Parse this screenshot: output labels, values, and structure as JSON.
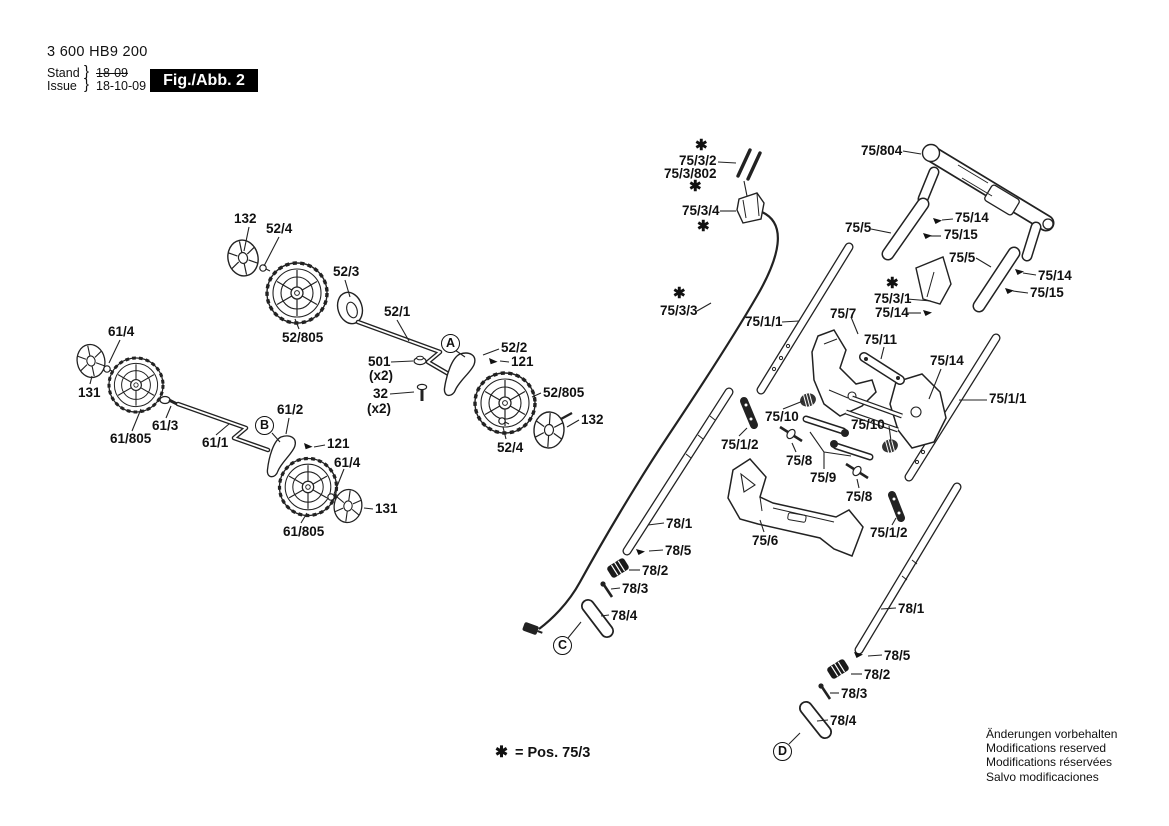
{
  "header": {
    "type_number": "3 600 HB9 200",
    "stand_label": "Stand",
    "issue_label": "Issue",
    "brace": "}",
    "old_date": "18-09",
    "new_date": "18-10-09",
    "figure_label": "Fig./Abb. 2"
  },
  "legend": {
    "asterisk": "✱",
    "text": "= Pos. 75/3"
  },
  "footer_lines": [
    "Änderungen vorbehalten",
    "Modifications reserved",
    "Modifications réservées",
    "Salvo modificaciones"
  ],
  "view_markers": {
    "a": "A",
    "b": "B",
    "c": "C",
    "d": "D"
  },
  "callouts": [
    {
      "text": "132"
    },
    {
      "text": "52/4"
    },
    {
      "text": "52/3"
    },
    {
      "text": "52/1"
    },
    {
      "text": "52/805"
    },
    {
      "text": "501"
    },
    {
      "text": "(x2)"
    },
    {
      "text": "32"
    },
    {
      "text": "(x2)"
    },
    {
      "text": "52/2"
    },
    {
      "text": "121"
    },
    {
      "text": "52/805"
    },
    {
      "text": "132"
    },
    {
      "text": "52/4"
    },
    {
      "text": "61/4"
    },
    {
      "text": "131"
    },
    {
      "text": "61/805"
    },
    {
      "text": "61/3"
    },
    {
      "text": "61/1"
    },
    {
      "text": "61/2"
    },
    {
      "text": "121"
    },
    {
      "text": "61/4"
    },
    {
      "text": "131"
    },
    {
      "text": "61/805"
    },
    {
      "text": "✱"
    },
    {
      "text": "75/3/2"
    },
    {
      "text": "75/3/802"
    },
    {
      "text": "✱"
    },
    {
      "text": "75/3/4"
    },
    {
      "text": "✱"
    },
    {
      "text": "75/804"
    },
    {
      "text": "75/5"
    },
    {
      "text": "75/14"
    },
    {
      "text": "75/15"
    },
    {
      "text": "75/5"
    },
    {
      "text": "75/14"
    },
    {
      "text": "75/15"
    },
    {
      "text": "✱"
    },
    {
      "text": "75/3/1"
    },
    {
      "text": "75/14"
    },
    {
      "text": "✱"
    },
    {
      "text": "75/3/3"
    },
    {
      "text": "75/1/1"
    },
    {
      "text": "75/7"
    },
    {
      "text": "75/11"
    },
    {
      "text": "75/14"
    },
    {
      "text": "75/1/1"
    },
    {
      "text": "75/10"
    },
    {
      "text": "75/10"
    },
    {
      "text": "75/1/2"
    },
    {
      "text": "75/8"
    },
    {
      "text": "75/9"
    },
    {
      "text": "75/8"
    },
    {
      "text": "75/6"
    },
    {
      "text": "75/1/2"
    },
    {
      "text": "78/1"
    },
    {
      "text": "78/5"
    },
    {
      "text": "78/2"
    },
    {
      "text": "78/3"
    },
    {
      "text": "78/4"
    },
    {
      "text": "78/1"
    },
    {
      "text": "78/5"
    },
    {
      "text": "78/2"
    },
    {
      "text": "78/3"
    },
    {
      "text": "78/4"
    }
  ]
}
